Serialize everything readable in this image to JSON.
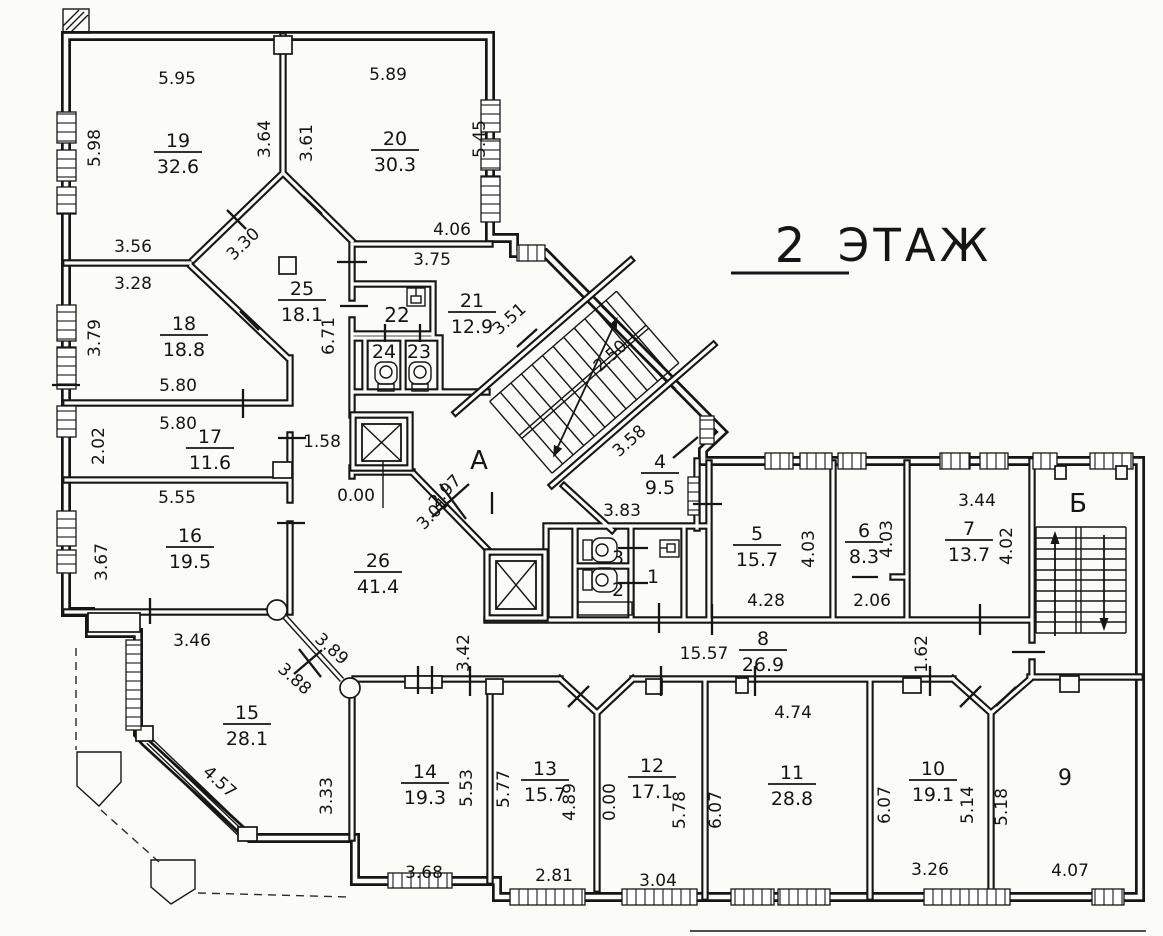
{
  "title": {
    "number": "2",
    "word": "ЭТАЖ"
  },
  "colors": {
    "paper": "#fbfbf7",
    "ink": "#161616"
  },
  "floor_plan": {
    "rooms": [
      {
        "number": "19",
        "area": "32.6",
        "x": 178,
        "y": 152
      },
      {
        "number": "20",
        "area": "30.3",
        "x": 395,
        "y": 150
      },
      {
        "number": "25",
        "area": "18.1",
        "x": 302,
        "y": 300
      },
      {
        "number": "18",
        "area": "18.8",
        "x": 184,
        "y": 335
      },
      {
        "number": "17",
        "area": "11.6",
        "x": 210,
        "y": 448
      },
      {
        "number": "16",
        "area": "19.5",
        "x": 190,
        "y": 547
      },
      {
        "number": "15",
        "area": "28.1",
        "x": 247,
        "y": 724
      },
      {
        "number": "26",
        "area": "41.4",
        "x": 378,
        "y": 572
      },
      {
        "number": "21",
        "area": "12.9",
        "x": 472,
        "y": 312
      },
      {
        "number": "4",
        "area": "9.5",
        "x": 660,
        "y": 473
      },
      {
        "number": "5",
        "area": "15.7",
        "x": 757,
        "y": 545
      },
      {
        "number": "6",
        "area": "8.3",
        "x": 864,
        "y": 542
      },
      {
        "number": "7",
        "area": "13.7",
        "x": 969,
        "y": 540
      },
      {
        "number": "8",
        "area": "26.9",
        "x": 763,
        "y": 650
      },
      {
        "number": "14",
        "area": "19.3",
        "x": 425,
        "y": 783
      },
      {
        "number": "13",
        "area": "15.7",
        "x": 545,
        "y": 780
      },
      {
        "number": "12",
        "area": "17.1",
        "x": 652,
        "y": 777
      },
      {
        "number": "11",
        "area": "28.8",
        "x": 792,
        "y": 784
      },
      {
        "number": "10",
        "area": "19.1",
        "x": 933,
        "y": 780
      }
    ],
    "marks": [
      {
        "t": "А",
        "x": 479,
        "y": 469,
        "s": 26
      },
      {
        "t": "Б",
        "x": 1078,
        "y": 512,
        "s": 26
      },
      {
        "t": "22",
        "x": 397,
        "y": 322,
        "s": 20
      },
      {
        "t": "24",
        "x": 384,
        "y": 358,
        "s": 19
      },
      {
        "t": "23",
        "x": 419,
        "y": 358,
        "s": 19
      },
      {
        "t": "3",
        "x": 618,
        "y": 564,
        "s": 19
      },
      {
        "t": "2",
        "x": 618,
        "y": 596,
        "s": 19
      },
      {
        "t": "1",
        "x": 653,
        "y": 583,
        "s": 19
      },
      {
        "t": "9",
        "x": 1065,
        "y": 785,
        "s": 22
      }
    ],
    "dimensions": [
      {
        "t": "5.95",
        "x": 177,
        "y": 84
      },
      {
        "t": "5.89",
        "x": 388,
        "y": 80
      },
      {
        "t": "5.98",
        "x": 100,
        "y": 148,
        "r": -90
      },
      {
        "t": "3.64",
        "x": 270,
        "y": 139,
        "r": -90
      },
      {
        "t": "3.61",
        "x": 312,
        "y": 143,
        "r": -90
      },
      {
        "t": "5.45",
        "x": 485,
        "y": 139,
        "r": -90
      },
      {
        "t": "3.56",
        "x": 133,
        "y": 252
      },
      {
        "t": "3.30",
        "x": 247,
        "y": 248,
        "r": -44
      },
      {
        "t": "3.28",
        "x": 133,
        "y": 289
      },
      {
        "t": "4.06",
        "x": 452,
        "y": 235
      },
      {
        "t": "3.75",
        "x": 432,
        "y": 265
      },
      {
        "t": "3.79",
        "x": 100,
        "y": 338,
        "r": -90
      },
      {
        "t": "6.71",
        "x": 334,
        "y": 336,
        "r": -90
      },
      {
        "t": "5.80",
        "x": 178,
        "y": 391
      },
      {
        "t": "5.80",
        "x": 178,
        "y": 429
      },
      {
        "t": "2.02",
        "x": 104,
        "y": 446,
        "r": -90
      },
      {
        "t": "5.55",
        "x": 177,
        "y": 503
      },
      {
        "t": "3.67",
        "x": 107,
        "y": 562,
        "r": -90
      },
      {
        "t": "1.58",
        "x": 322,
        "y": 447
      },
      {
        "t": "0.00",
        "x": 356,
        "y": 501
      },
      {
        "t": "3.51",
        "x": 513,
        "y": 323,
        "r": -42
      },
      {
        "t": "2.50",
        "x": 614,
        "y": 360,
        "r": -42
      },
      {
        "t": "3.58",
        "x": 633,
        "y": 445,
        "r": -42
      },
      {
        "t": "2.97",
        "x": 449,
        "y": 495,
        "r": -46
      },
      {
        "t": "3.01",
        "x": 437,
        "y": 517,
        "r": -46
      },
      {
        "t": "3.83",
        "x": 622,
        "y": 516
      },
      {
        "t": "3.46",
        "x": 192,
        "y": 646
      },
      {
        "t": "3.89",
        "x": 328,
        "y": 653,
        "r": 42
      },
      {
        "t": "3.88",
        "x": 291,
        "y": 683,
        "r": 42
      },
      {
        "t": "4.57",
        "x": 216,
        "y": 786,
        "r": 42
      },
      {
        "t": "3.33",
        "x": 332,
        "y": 796,
        "r": -90
      },
      {
        "t": "3.42",
        "x": 469,
        "y": 653,
        "r": -90
      },
      {
        "t": "15.57",
        "x": 704,
        "y": 659
      },
      {
        "t": "1.62",
        "x": 927,
        "y": 654,
        "r": -90
      },
      {
        "t": "4.74",
        "x": 793,
        "y": 718
      },
      {
        "t": "4.28",
        "x": 766,
        "y": 606
      },
      {
        "t": "2.06",
        "x": 872,
        "y": 606
      },
      {
        "t": "4.03",
        "x": 814,
        "y": 549,
        "r": -90
      },
      {
        "t": "4.03",
        "x": 892,
        "y": 539,
        "r": -90
      },
      {
        "t": "3.44",
        "x": 977,
        "y": 506
      },
      {
        "t": "4.02",
        "x": 1012,
        "y": 546,
        "r": -90
      },
      {
        "t": "5.53",
        "x": 472,
        "y": 788,
        "r": -90
      },
      {
        "t": "5.77",
        "x": 509,
        "y": 789,
        "r": -90
      },
      {
        "t": "4.89",
        "x": 575,
        "y": 802,
        "r": -90
      },
      {
        "t": "0.00",
        "x": 615,
        "y": 802,
        "r": -90
      },
      {
        "t": "5.78",
        "x": 685,
        "y": 810,
        "r": -90
      },
      {
        "t": "6.07",
        "x": 721,
        "y": 810,
        "r": -90
      },
      {
        "t": "6.07",
        "x": 890,
        "y": 805,
        "r": -90
      },
      {
        "t": "5.14",
        "x": 973,
        "y": 805,
        "r": -90
      },
      {
        "t": "5.18",
        "x": 1007,
        "y": 807,
        "r": -90
      },
      {
        "t": "3.68",
        "x": 424,
        "y": 878
      },
      {
        "t": "2.81",
        "x": 554,
        "y": 881
      },
      {
        "t": "3.04",
        "x": 658,
        "y": 886
      },
      {
        "t": "3.26",
        "x": 930,
        "y": 875
      },
      {
        "t": "4.07",
        "x": 1070,
        "y": 876
      }
    ]
  }
}
